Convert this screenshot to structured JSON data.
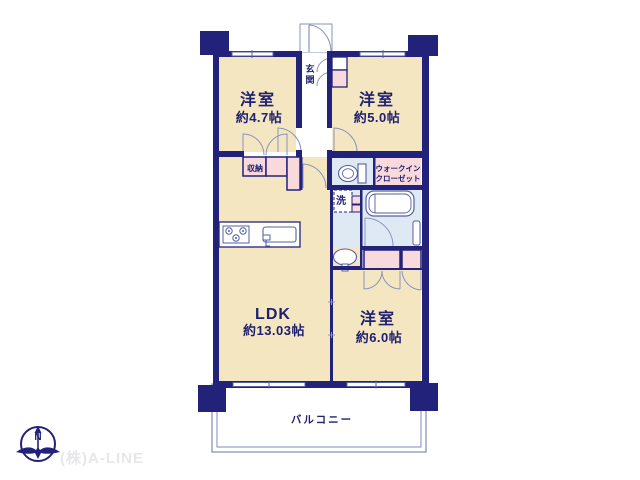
{
  "plan": {
    "title": "apartment-floor-plan",
    "rooms": {
      "bedroom1": {
        "name": "洋室",
        "size": "約4.7帖"
      },
      "bedroom2": {
        "name": "洋室",
        "size": "約5.0帖"
      },
      "bedroom3": {
        "name": "洋室",
        "size": "約6.0帖"
      },
      "ldk": {
        "name": "LDK",
        "size": "約13.03帖"
      },
      "entrance": {
        "char1": "玄",
        "char2": "関"
      },
      "storage": {
        "label": "収納"
      },
      "laundry": {
        "label": "洗"
      },
      "walk_in_closet": {
        "line1": "ウォークイン",
        "line2": "クローゼット"
      },
      "balcony": {
        "label": "バルコニー"
      }
    },
    "colors": {
      "wall": "#22227a",
      "room_fill": "#f5e6c2",
      "closet_fill": "#f8d9dc",
      "wet_area_fill": "#dfe9f4",
      "fixture_line": "#8b93bf",
      "text": "#1f2070"
    }
  },
  "footer": {
    "compass_north": "N",
    "company": "(株)A-LINE"
  }
}
